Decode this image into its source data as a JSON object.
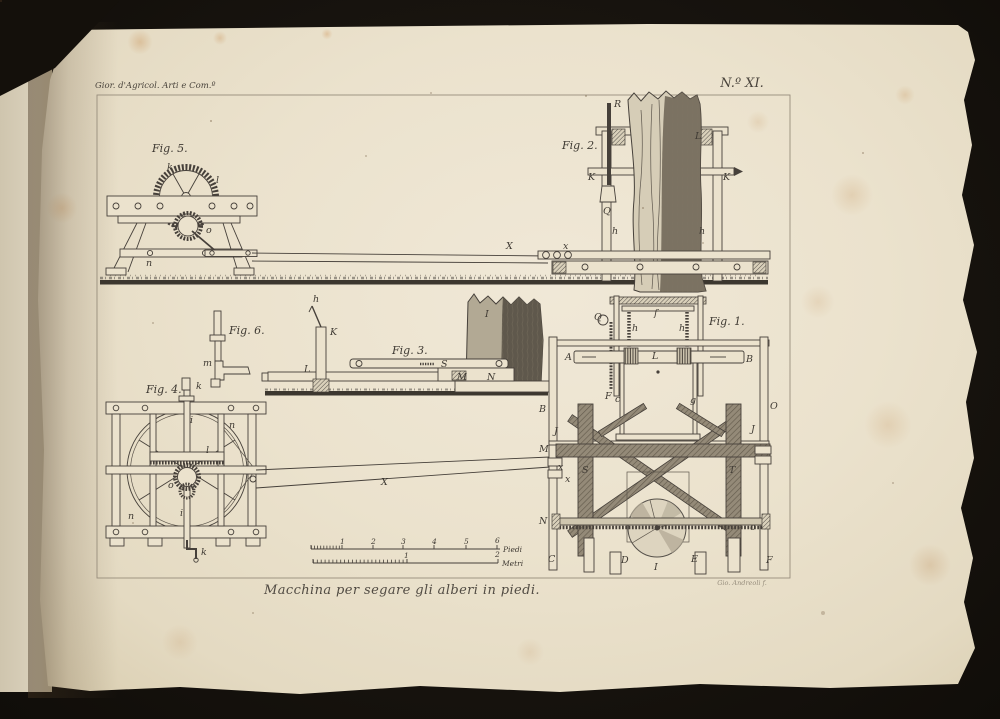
{
  "page": {
    "header_left": "Gior. d'Agricol. Arti e Com.º",
    "plate_number": "N.º XI.",
    "caption": "Macchina per segare gli alberi in piedi.",
    "signature": "Gio. Andreoli f.",
    "colors": {
      "background": "#14110d",
      "paper": "#ebe2cd",
      "ink": "#46403a",
      "stain": "#be7832"
    }
  },
  "figures": {
    "fig1": {
      "title": "Fig. 1.",
      "parts": {
        "q": "Q",
        "f": "f",
        "h_left": "h",
        "h_right": "h",
        "a": "A",
        "l": "L",
        "b": "B",
        "c": "c",
        "g": "g",
        "f2": "F",
        "b_left": "B",
        "o_right": "O",
        "j_left": "J",
        "j_right": "J",
        "m": "M",
        "s": "S",
        "t": "T",
        "x1": "x",
        "x2": "x",
        "n": "N",
        "o2": "o",
        "c_bottom": "C",
        "d_bottom": "D",
        "e_bottom": "E",
        "f_bottom": "F",
        "i_bottom": "I"
      }
    },
    "fig2": {
      "title": "Fig. 2.",
      "parts": {
        "r": "R",
        "l": "L",
        "k_left": "K",
        "k_right": "K",
        "q": "Q",
        "h_left": "h",
        "h_right": "h",
        "x": "x"
      }
    },
    "fig3": {
      "title": "Fig. 3.",
      "parts": {
        "h": "h",
        "k": "K",
        "l": "L",
        "s": "S",
        "m": "M",
        "n": "N",
        "i": "I"
      }
    },
    "fig4": {
      "title": "Fig. 4.",
      "parts": {
        "k_top": "k",
        "k_bottom": "k",
        "i_top": "i",
        "i_bottom": "i",
        "l": "l",
        "o": "o",
        "n_left": "n",
        "n_right": "n"
      }
    },
    "fig5": {
      "title": "Fig. 5.",
      "parts": {
        "k": "k",
        "l": "l",
        "o": "o",
        "n": "n"
      }
    },
    "fig6": {
      "title": "Fig. 6.",
      "parts": {
        "m": "m"
      }
    }
  },
  "beams": {
    "upper": "X",
    "lower": "X"
  },
  "scale_bar": {
    "piedi": {
      "label": "Piedi",
      "ticks": [
        "1",
        "2",
        "3",
        "4",
        "5",
        "6"
      ]
    },
    "metri": {
      "label": "Metri",
      "ticks": [
        "1",
        "2"
      ]
    }
  }
}
